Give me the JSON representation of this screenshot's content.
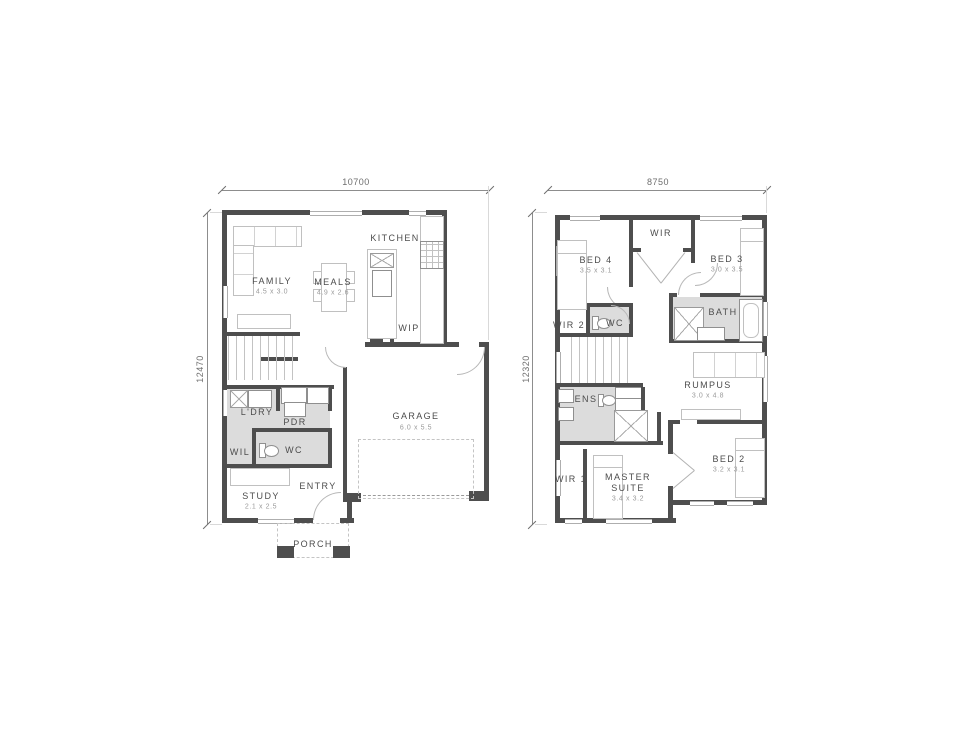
{
  "colors": {
    "wall": "#4e4e4e",
    "wet_area": "#dcdcdc",
    "furniture_line": "#c0c0c0",
    "label_text": "#4c4c4c",
    "dim_text": "#6d6d6d"
  },
  "ground_floor": {
    "dim_width": "10700",
    "dim_height": "12470",
    "labels": {
      "family": {
        "name": "FAMILY",
        "size": "4.5 x 3.0"
      },
      "meals": {
        "name": "MEALS",
        "size": "4.9 x 2.6"
      },
      "kitchen": {
        "name": "KITCHEN"
      },
      "wip": {
        "name": "WIP"
      },
      "garage": {
        "name": "GARAGE",
        "size": "6.0 x 5.5"
      },
      "ldry": {
        "name": "L'DRY"
      },
      "pdr": {
        "name": "PDR"
      },
      "wil": {
        "name": "WIL"
      },
      "wc": {
        "name": "WC"
      },
      "study": {
        "name": "STUDY",
        "size": "2.1 x 2.5"
      },
      "entry": {
        "name": "ENTRY"
      },
      "porch": {
        "name": "PORCH"
      }
    }
  },
  "first_floor": {
    "dim_width": "8750",
    "dim_height": "12320",
    "labels": {
      "bed4": {
        "name": "BED 4",
        "size": "3.5 x 3.1"
      },
      "wir": {
        "name": "WIR"
      },
      "bed3": {
        "name": "BED 3",
        "size": "3.0 x 3.5"
      },
      "wir2": {
        "name": "WIR 2"
      },
      "wc": {
        "name": "WC"
      },
      "bath": {
        "name": "BATH"
      },
      "ens": {
        "name": "ENS"
      },
      "rumpus": {
        "name": "RUMPUS",
        "size": "3.0 x 4.8"
      },
      "wir1": {
        "name": "WIR 1"
      },
      "master": {
        "name": "MASTER SUITE",
        "size": "3.4 x 3.2"
      },
      "bed2": {
        "name": "BED 2",
        "size": "3.2 x 3.1"
      }
    }
  }
}
